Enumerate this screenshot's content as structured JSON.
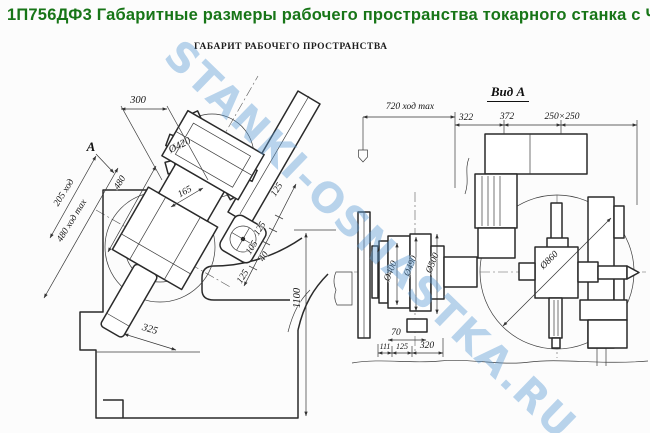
{
  "page": {
    "title": "1П756ДФ3 Габаритные размеры рабочего пространства токарного станка с ЧПУ",
    "subtitle": "ГАБАРИТ РАБОЧЕГО ПРОСТРАНСТВА",
    "watermark": "STANKI-OSNASTKA.RU"
  },
  "colors": {
    "title_green": "#177517",
    "watermark_blue": "#5b9bd5",
    "line_black": "#2a2a2a"
  },
  "left_view": {
    "dims": {
      "d300": "300",
      "view_label": "A",
      "dia_turret": "Ø420",
      "d480": "480",
      "stroke205": "205 ход",
      "stroke480": "480 ход max",
      "d165": "165",
      "chain": [
        "125",
        "125",
        "105",
        "40",
        "125"
      ],
      "d325": "325",
      "d1100": "1100"
    }
  },
  "right_view": {
    "label": "Вид А",
    "dims": {
      "stroke720": "720 ход max",
      "d322": "322",
      "d372": "372",
      "d250": "250×250",
      "dia400": "Ø400",
      "dia490": "Ø490",
      "dia500": "Ø500",
      "dia860": "Ø860",
      "d70": "70",
      "d111": "111",
      "d125": "125",
      "d320": "320"
    }
  }
}
